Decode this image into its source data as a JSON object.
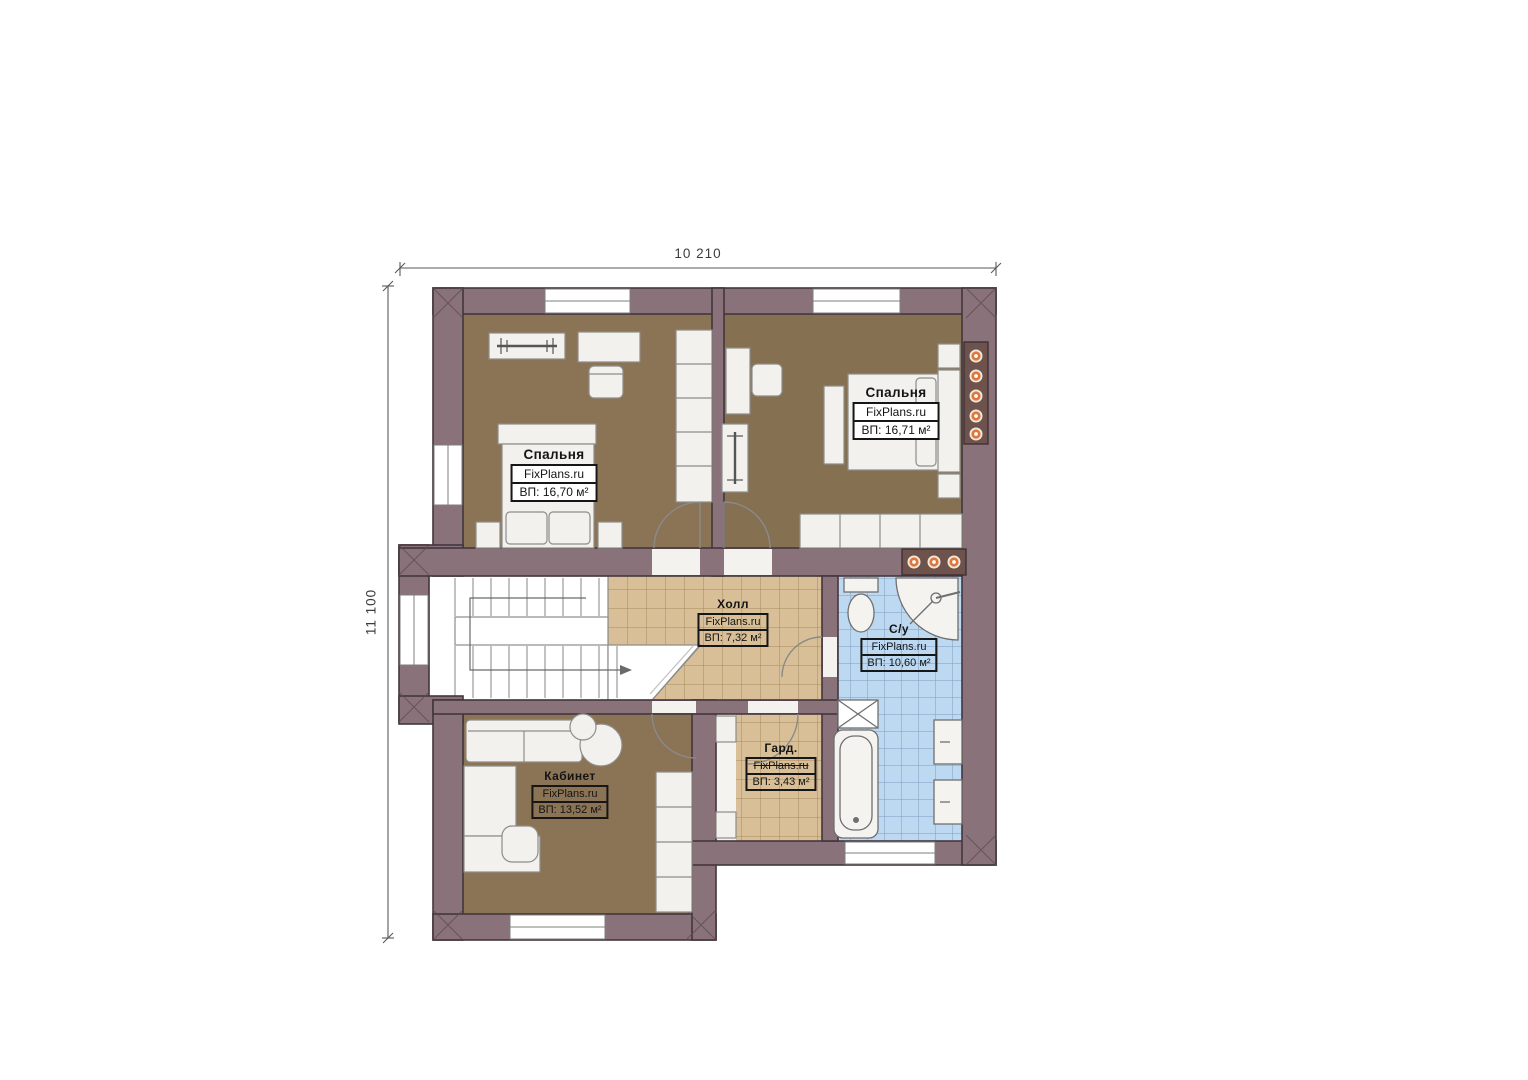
{
  "page": {
    "type": "floor-plan",
    "background": "#ffffff"
  },
  "watermark": "FixPlans.ru",
  "dimensions": {
    "width_label": "10 210",
    "height_label": "11 100"
  },
  "rooms": [
    {
      "id": "bedroom-left",
      "name": "Спальня",
      "area": "ВП: 16,70 м²"
    },
    {
      "id": "bedroom-right",
      "name": "Спальня",
      "area": "ВП: 16,71 м²"
    },
    {
      "id": "hall",
      "name": "Холл",
      "area": "ВП: 7,32 м²"
    },
    {
      "id": "bathroom",
      "name": "С/у",
      "area": "ВП: 10,60 м²"
    },
    {
      "id": "wardrobe",
      "name": "Гард.",
      "area": "ВП: 3,43 м²"
    },
    {
      "id": "office",
      "name": "Кабинет",
      "area": "ВП: 13,52 м²"
    }
  ],
  "colors": {
    "wall": "#8a727b",
    "wall_outline": "#43363e",
    "floor_wood": "#8b7355",
    "floor_tile_beige": "#d9bf97",
    "floor_tile_blue": "#bdd9f2",
    "fixture_white": "#f2f1ee",
    "accent_orange": "#e0773a"
  }
}
